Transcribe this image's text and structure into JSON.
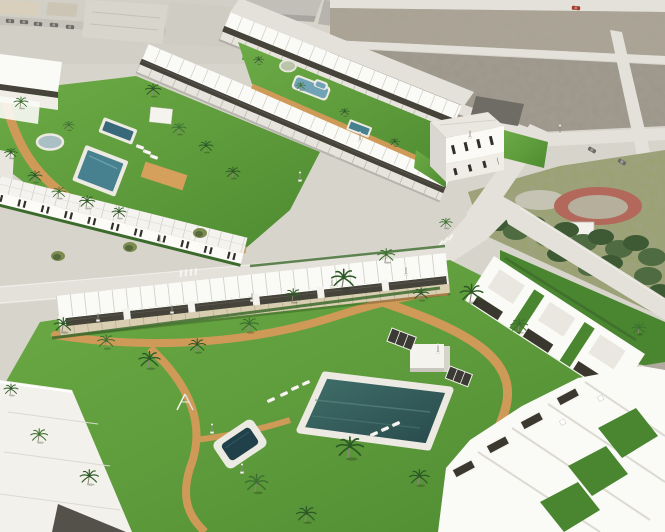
{
  "colors": {
    "road": "#d7d4cc",
    "roadLight": "#e3e1d9",
    "kerb": "#f0efe9",
    "urbanBase": "#d2cfc6",
    "beige1": "#d8cfbd",
    "beige2": "#ccc5b5",
    "greyRoof1": "#d8d5cd",
    "greyRoof2": "#cfccc4",
    "greyBldg": "#c2bfb9",
    "greyBldgSide": "#a8a5a0",
    "lotMid": "#aba496",
    "lotDark": "#9c968a",
    "parkGrass": "#9aa26c",
    "treeDark": "#3e5a34",
    "treeMid": "#4f6b42",
    "redTrack": "#b3685c",
    "trackInner": "#b5af9b",
    "lawn": "#5d9a3b",
    "lawnDark": "#4a8530",
    "hedge": "#3c6a2d",
    "path": "#cf9a58",
    "white": "#f7f6f1",
    "roofWhite": "#fafaf6",
    "roofShade": "#e6e4dc",
    "roofLine": "#ceccc4",
    "facade": "#efede6",
    "pergola": "#46433b",
    "window": "#32302b",
    "deck": "#d9cdb2",
    "poolTeal": "#47808f",
    "poolBlue": "#6fa3b5",
    "poolNavy": "#39687a",
    "poolDark": "#20404a",
    "fountain": "#a9bfc4",
    "palmFrondA": "#2d5926",
    "palmFrondB": "#3c7030",
    "palmTrunk": "#8b8679",
    "oliveTree": "#7c8c50",
    "oliveTreeDark": "#55683c",
    "autumnTree": "#b98a4a",
    "carGrey": "#6b6b66",
    "carRed": "#a23a2e",
    "dirtRight": "#b2aca0"
  },
  "scene": {
    "palms": [
      [
        20,
        108,
        0.5,
        "b"
      ],
      [
        10,
        158,
        0.45,
        "a"
      ],
      [
        34,
        182,
        0.5,
        "a"
      ],
      [
        58,
        198,
        0.5,
        "b"
      ],
      [
        86,
        208,
        0.55,
        "a"
      ],
      [
        118,
        218,
        0.5,
        "a"
      ],
      [
        152,
        96,
        0.55,
        "a"
      ],
      [
        178,
        134,
        0.5,
        "b"
      ],
      [
        205,
        152,
        0.5,
        "a"
      ],
      [
        232,
        178,
        0.5,
        "a"
      ],
      [
        68,
        130,
        0.4,
        "b"
      ],
      [
        258,
        64,
        0.35,
        "a"
      ],
      [
        300,
        90,
        0.35,
        "b"
      ],
      [
        344,
        116,
        0.35,
        "a"
      ],
      [
        394,
        146,
        0.35,
        "a"
      ],
      [
        445,
        228,
        0.45,
        "b"
      ],
      [
        62,
        332,
        0.65,
        "a"
      ],
      [
        105,
        348,
        0.6,
        "b"
      ],
      [
        148,
        368,
        0.75,
        "a"
      ],
      [
        196,
        352,
        0.6,
        "a"
      ],
      [
        248,
        332,
        0.65,
        "b"
      ],
      [
        292,
        302,
        0.6,
        "a"
      ],
      [
        342,
        288,
        0.85,
        "a"
      ],
      [
        385,
        262,
        0.6,
        "b"
      ],
      [
        420,
        300,
        0.55,
        "a"
      ],
      [
        470,
        302,
        0.8,
        "a"
      ],
      [
        518,
        332,
        0.6,
        "b"
      ],
      [
        348,
        458,
        0.95,
        "a"
      ],
      [
        255,
        492,
        0.8,
        "b"
      ],
      [
        305,
        522,
        0.7,
        "a"
      ],
      [
        418,
        485,
        0.7,
        "a"
      ],
      [
        38,
        442,
        0.6,
        "b"
      ],
      [
        88,
        484,
        0.65,
        "a"
      ],
      [
        10,
        395,
        0.5,
        "a"
      ],
      [
        638,
        334,
        0.5,
        "b"
      ]
    ],
    "loungers": [
      [
        284,
        394,
        -24
      ],
      [
        295,
        388,
        -24
      ],
      [
        306,
        383,
        -24
      ],
      [
        271,
        400,
        -24
      ],
      [
        374,
        434,
        -24
      ],
      [
        385,
        429,
        -24
      ],
      [
        396,
        424,
        -24
      ],
      [
        140,
        147,
        20
      ],
      [
        147,
        152,
        20
      ],
      [
        154,
        157,
        20
      ]
    ],
    "lamps": [
      [
        98,
        320
      ],
      [
        172,
        312
      ],
      [
        252,
        300
      ],
      [
        332,
        286
      ],
      [
        406,
        274
      ],
      [
        212,
        432
      ],
      [
        242,
        472
      ],
      [
        438,
        352
      ],
      [
        160,
        242
      ],
      [
        360,
        140
      ],
      [
        470,
        137
      ],
      [
        560,
        133
      ],
      [
        300,
        180
      ]
    ],
    "cars_grey": [
      [
        10,
        21,
        4
      ],
      [
        24,
        22,
        4
      ],
      [
        38,
        24,
        4
      ],
      [
        54,
        25,
        4
      ],
      [
        70,
        27,
        4
      ],
      [
        592,
        150,
        30
      ],
      [
        622,
        162,
        30
      ]
    ],
    "cars_red": [
      [
        576,
        8,
        4
      ]
    ]
  }
}
